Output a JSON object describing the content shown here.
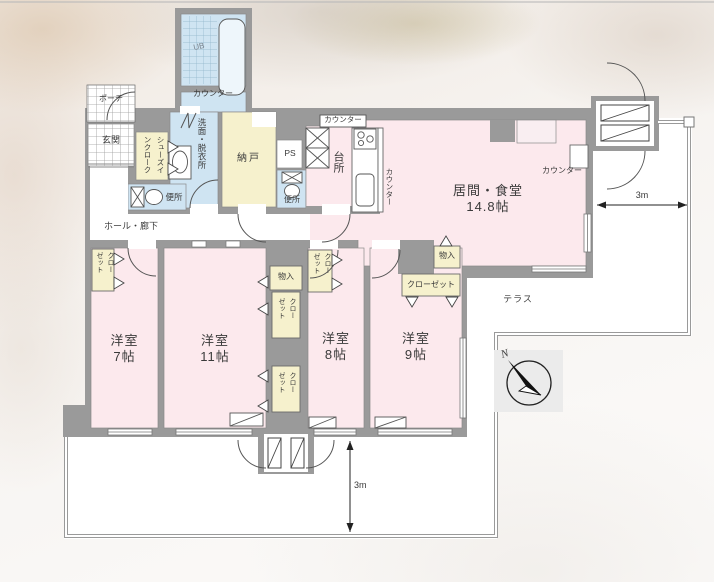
{
  "floorplan": {
    "title": "間取り図",
    "rooms": {
      "living_name": "居間・食堂",
      "living_size": "14.8帖",
      "kitchen": "台所",
      "bed7_name": "洋室",
      "bed7_size": "7帖",
      "bed11_name": "洋室",
      "bed11_size": "11帖",
      "bed8_name": "洋室",
      "bed8_size": "8帖",
      "bed9_name": "洋室",
      "bed9_size": "9帖",
      "nando": "納戸",
      "washroom": "洗面・脱衣所",
      "genkan": "玄関",
      "porch": "ポーチ",
      "hall": "ホール・廊下",
      "toilet": "便所",
      "shoes_cloak": "シューズインクローク",
      "terrace": "テラス",
      "ps": "PS",
      "ub": "UB"
    },
    "fixtures": {
      "counter": "カウンター",
      "closet": "クローゼット",
      "storage": "物入"
    },
    "dimensions": {
      "terrace_width": "3m",
      "balcony_depth": "3m"
    },
    "compass": {
      "north_label": "N"
    },
    "colors": {
      "room_pink": "#fce9ed",
      "wet_blue": "#cfe4f2",
      "storage_yellow": "#f6f1cd",
      "wall_gray": "#9a9a9a"
    }
  }
}
